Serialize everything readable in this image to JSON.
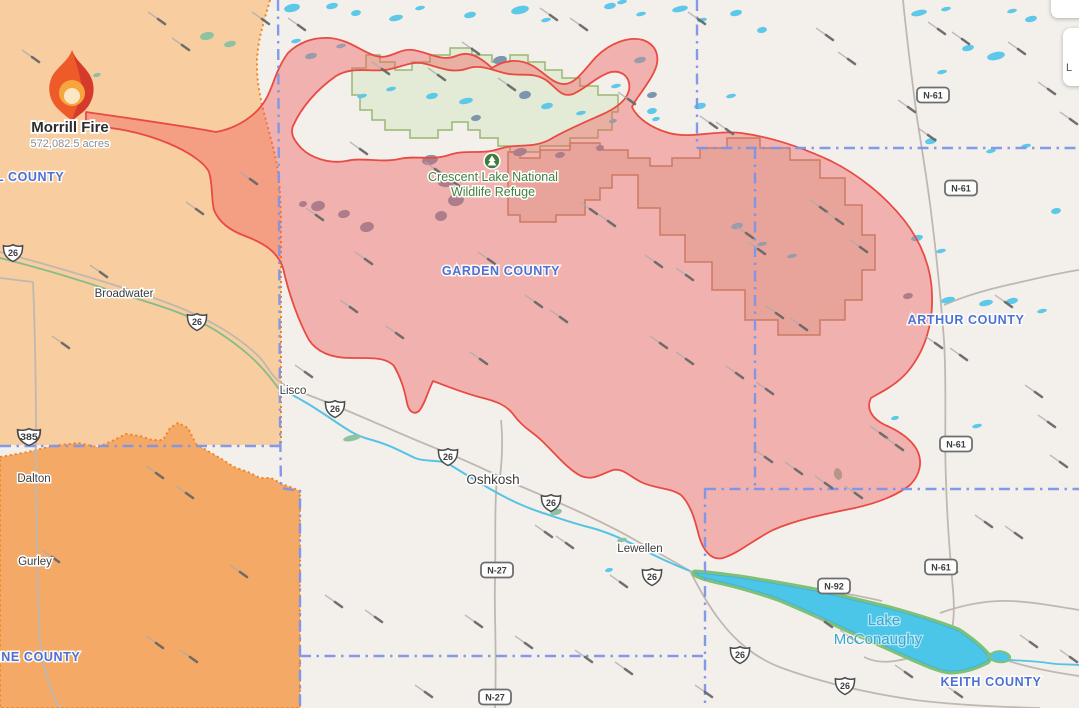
{
  "fire": {
    "name": "Morrill Fire",
    "acres_label": "572,082.5 acres",
    "marker": {
      "x": 72,
      "y": 86
    },
    "label": {
      "x": 70,
      "y": 132,
      "acres_y": 147
    },
    "perimeter_color": "#e94a42",
    "perimeter_fill": "rgba(239,93,90,0.42)"
  },
  "zones": {
    "warning_color": "#f8cda0",
    "order_color": "#f5a967",
    "border_color": "#ef8420"
  },
  "cards": [
    {
      "label": ""
    },
    {
      "label": "L"
    }
  ],
  "map": {
    "county_line_color": "#7d95e8",
    "counties": [
      {
        "name": "LL COUNTY",
        "x": 26,
        "y": 181
      },
      {
        "name": "GARDEN COUNTY",
        "x": 501,
        "y": 275
      },
      {
        "name": "ARTHUR COUNTY",
        "x": 966,
        "y": 324
      },
      {
        "name": "KEITH COUNTY",
        "x": 991,
        "y": 686
      },
      {
        "name": "NNE COUNTY",
        "x": 36,
        "y": 661
      }
    ],
    "towns": [
      {
        "name": "Broadwater",
        "x": 124,
        "y": 297,
        "big": false
      },
      {
        "name": "Lisco",
        "x": 293,
        "y": 394,
        "big": false
      },
      {
        "name": "Oshkosh",
        "x": 493,
        "y": 484,
        "big": true
      },
      {
        "name": "Lewellen",
        "x": 640,
        "y": 552,
        "big": false
      },
      {
        "name": "Dalton",
        "x": 34,
        "y": 482,
        "big": false
      },
      {
        "name": "Gurley",
        "x": 35,
        "y": 565,
        "big": false
      }
    ],
    "water_labels": [
      {
        "name": "Lake",
        "x": 884,
        "y": 625
      },
      {
        "name": "McConaughy",
        "x": 878,
        "y": 644
      }
    ],
    "refuge_label": {
      "line1": "Crescent Lake National",
      "line2": "Wildlife Refuge",
      "x": 493,
      "y": 181
    },
    "shields_us": [
      {
        "label": "26",
        "x": 13,
        "y": 253
      },
      {
        "label": "26",
        "x": 197,
        "y": 322
      },
      {
        "label": "26",
        "x": 335,
        "y": 409
      },
      {
        "label": "26",
        "x": 448,
        "y": 457
      },
      {
        "label": "26",
        "x": 551,
        "y": 503
      },
      {
        "label": "26",
        "x": 652,
        "y": 577
      },
      {
        "label": "26",
        "x": 740,
        "y": 655
      },
      {
        "label": "26",
        "x": 845,
        "y": 686
      },
      {
        "label": "385",
        "x": 27,
        "y": 437
      }
    ],
    "shields_state": [
      {
        "label": "N-61",
        "x": 933,
        "y": 95
      },
      {
        "label": "N-61",
        "x": 961,
        "y": 188
      },
      {
        "label": "N-61",
        "x": 956,
        "y": 444
      },
      {
        "label": "N-61",
        "x": 941,
        "y": 567
      },
      {
        "label": "N-92",
        "x": 834,
        "y": 586
      },
      {
        "label": "N-27",
        "x": 497,
        "y": 570
      },
      {
        "label": "N-27",
        "x": 495,
        "y": 697
      }
    ],
    "wind_streaks": [
      [
        148,
        12
      ],
      [
        172,
        38
      ],
      [
        252,
        12
      ],
      [
        288,
        18
      ],
      [
        372,
        62
      ],
      [
        428,
        68
      ],
      [
        540,
        8
      ],
      [
        570,
        18
      ],
      [
        688,
        12
      ],
      [
        816,
        28
      ],
      [
        838,
        52
      ],
      [
        928,
        22
      ],
      [
        952,
        32
      ],
      [
        1008,
        42
      ],
      [
        898,
        100
      ],
      [
        918,
        128
      ],
      [
        1038,
        82
      ],
      [
        1060,
        112
      ],
      [
        186,
        202
      ],
      [
        240,
        172
      ],
      [
        306,
        208
      ],
      [
        340,
        300
      ],
      [
        386,
        326
      ],
      [
        462,
        42
      ],
      [
        470,
        352
      ],
      [
        498,
        78
      ],
      [
        618,
        92
      ],
      [
        580,
        202
      ],
      [
        598,
        214
      ],
      [
        645,
        255
      ],
      [
        676,
        268
      ],
      [
        700,
        116
      ],
      [
        716,
        122
      ],
      [
        736,
        226
      ],
      [
        748,
        242
      ],
      [
        766,
        306
      ],
      [
        790,
        318
      ],
      [
        650,
        336
      ],
      [
        676,
        352
      ],
      [
        726,
        366
      ],
      [
        756,
        382
      ],
      [
        810,
        200
      ],
      [
        826,
        212
      ],
      [
        850,
        240
      ],
      [
        870,
        426
      ],
      [
        886,
        438
      ],
      [
        925,
        336
      ],
      [
        950,
        348
      ],
      [
        995,
        295
      ],
      [
        1025,
        385
      ],
      [
        1038,
        415
      ],
      [
        1050,
        455
      ],
      [
        975,
        515
      ],
      [
        1005,
        526
      ],
      [
        755,
        450
      ],
      [
        785,
        462
      ],
      [
        815,
        476
      ],
      [
        845,
        486
      ],
      [
        535,
        525
      ],
      [
        556,
        536
      ],
      [
        610,
        575
      ],
      [
        465,
        615
      ],
      [
        515,
        636
      ],
      [
        575,
        650
      ],
      [
        615,
        662
      ],
      [
        695,
        685
      ],
      [
        22,
        50
      ],
      [
        52,
        336
      ],
      [
        90,
        265
      ],
      [
        146,
        466
      ],
      [
        176,
        486
      ],
      [
        42,
        550
      ],
      [
        146,
        636
      ],
      [
        180,
        650
      ],
      [
        230,
        565
      ],
      [
        325,
        595
      ],
      [
        365,
        610
      ],
      [
        415,
        685
      ],
      [
        815,
        615
      ],
      [
        840,
        630
      ],
      [
        895,
        665
      ],
      [
        945,
        685
      ],
      [
        1020,
        635
      ],
      [
        350,
        142
      ],
      [
        425,
        162
      ],
      [
        445,
        176
      ],
      [
        295,
        365
      ],
      [
        525,
        295
      ],
      [
        550,
        310
      ],
      [
        478,
        252
      ],
      [
        355,
        252
      ],
      [
        940,
        560
      ],
      [
        1060,
        650
      ]
    ],
    "small_lakes": [
      [
        292,
        8,
        8,
        4
      ],
      [
        332,
        6,
        6,
        3
      ],
      [
        356,
        13,
        5,
        3
      ],
      [
        396,
        18,
        7,
        3
      ],
      [
        420,
        8,
        5,
        2
      ],
      [
        470,
        15,
        6,
        3
      ],
      [
        520,
        10,
        9,
        4
      ],
      [
        546,
        20,
        5,
        2
      ],
      [
        610,
        6,
        6,
        3
      ],
      [
        641,
        14,
        5,
        2
      ],
      [
        680,
        9,
        8,
        3
      ],
      [
        702,
        20,
        5,
        2
      ],
      [
        736,
        13,
        6,
        3
      ],
      [
        622,
        2,
        5,
        2
      ],
      [
        762,
        30,
        5,
        3
      ],
      [
        640,
        60,
        6,
        3
      ],
      [
        616,
        86,
        5,
        2
      ],
      [
        700,
        106,
        6,
        3
      ],
      [
        652,
        111,
        5,
        3
      ],
      [
        731,
        96,
        5,
        2
      ],
      [
        296,
        41,
        5,
        2
      ],
      [
        311,
        56,
        6,
        3
      ],
      [
        341,
        46,
        5,
        2
      ],
      [
        432,
        96,
        6,
        3
      ],
      [
        466,
        101,
        7,
        3
      ],
      [
        362,
        96,
        5,
        2
      ],
      [
        391,
        89,
        5,
        2
      ],
      [
        547,
        106,
        6,
        3
      ],
      [
        581,
        113,
        5,
        2
      ],
      [
        613,
        121,
        4,
        2
      ],
      [
        656,
        119,
        4,
        2
      ],
      [
        919,
        13,
        8,
        3
      ],
      [
        946,
        9,
        5,
        2
      ],
      [
        968,
        48,
        6,
        3
      ],
      [
        942,
        72,
        5,
        2
      ],
      [
        996,
        56,
        9,
        4
      ],
      [
        1031,
        19,
        6,
        3
      ],
      [
        1056,
        13,
        5,
        2
      ],
      [
        1012,
        11,
        5,
        2
      ],
      [
        931,
        141,
        6,
        3
      ],
      [
        991,
        151,
        5,
        2
      ],
      [
        737,
        226,
        6,
        3
      ],
      [
        762,
        244,
        5,
        2
      ],
      [
        792,
        256,
        5,
        2
      ],
      [
        917,
        238,
        6,
        3
      ],
      [
        941,
        251,
        5,
        2
      ],
      [
        1026,
        146,
        5,
        2
      ],
      [
        1056,
        211,
        5,
        3
      ],
      [
        1012,
        301,
        6,
        3
      ],
      [
        1042,
        311,
        5,
        2
      ],
      [
        977,
        426,
        5,
        2
      ],
      [
        948,
        300,
        7,
        3
      ],
      [
        986,
        303,
        7,
        3
      ],
      [
        895,
        418,
        4,
        2
      ],
      [
        1068,
        5,
        6,
        3
      ],
      [
        1075,
        60,
        5,
        3
      ],
      [
        609,
        570,
        4,
        2
      ]
    ],
    "slate_lakes": [
      [
        318,
        206,
        7,
        5
      ],
      [
        344,
        214,
        6,
        4
      ],
      [
        367,
        227,
        7,
        5
      ],
      [
        303,
        204,
        4,
        3
      ],
      [
        430,
        160,
        8,
        5
      ],
      [
        447,
        180,
        10,
        7
      ],
      [
        456,
        200,
        8,
        6
      ],
      [
        441,
        216,
        6,
        5
      ],
      [
        520,
        152,
        7,
        4
      ],
      [
        560,
        155,
        5,
        3
      ],
      [
        525,
        95,
        6,
        4
      ],
      [
        500,
        60,
        7,
        4
      ],
      [
        476,
        118,
        5,
        3
      ],
      [
        652,
        95,
        5,
        3
      ],
      [
        908,
        296,
        5,
        3
      ],
      [
        600,
        148,
        4,
        3
      ]
    ],
    "green_patches": [
      [
        352,
        438,
        9,
        3
      ],
      [
        556,
        512,
        6,
        3
      ],
      [
        622,
        540,
        5,
        2
      ],
      [
        838,
        474,
        4,
        6
      ],
      [
        207,
        36,
        7,
        4
      ],
      [
        230,
        44,
        6,
        3
      ],
      [
        97,
        75,
        4,
        2
      ]
    ]
  }
}
